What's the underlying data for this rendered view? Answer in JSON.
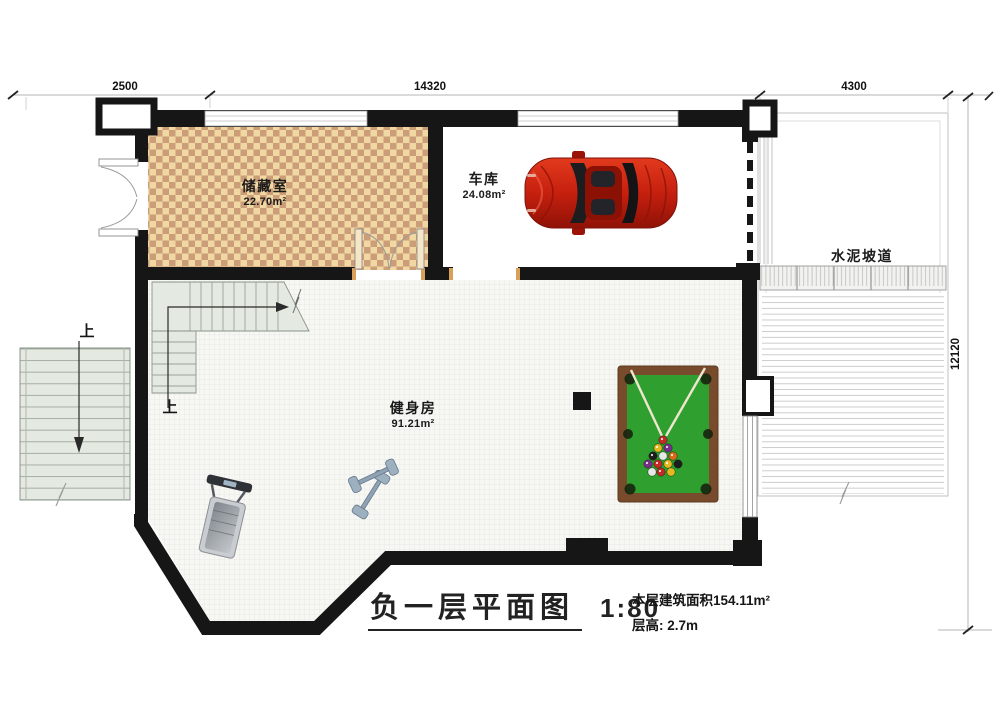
{
  "title": {
    "text": "负一层平面图",
    "scale": "1:80"
  },
  "notes": {
    "area": "本层建筑面积154.11m²",
    "floor_height": "层高: 2.7m"
  },
  "dimensions": {
    "top_left": "2500",
    "top_middle": "14320",
    "top_right": "4300",
    "right": "12120"
  },
  "rooms": {
    "storage": {
      "name": "储藏室",
      "area": "22.70m²"
    },
    "garage": {
      "name": "车库",
      "area": "24.08m²"
    },
    "gym": {
      "name": "健身房",
      "area": "91.21m²"
    },
    "ramp": {
      "name": "水泥坡道"
    }
  },
  "stairs": {
    "exterior_up": "上",
    "interior_up": "上"
  },
  "colors": {
    "wall": "#161616",
    "checker_light": "#f1d8a2",
    "checker_dark": "#cb9e79",
    "stair_fill": "#e4e9e1",
    "gym_floor": "#f7f7f4",
    "pool_frame": "#784b2c",
    "pool_felt": "#2f9f2f",
    "car_red": "#c6200f",
    "ramp_line": "#cbcbcb",
    "dimension_line": "#b5b5b5"
  }
}
